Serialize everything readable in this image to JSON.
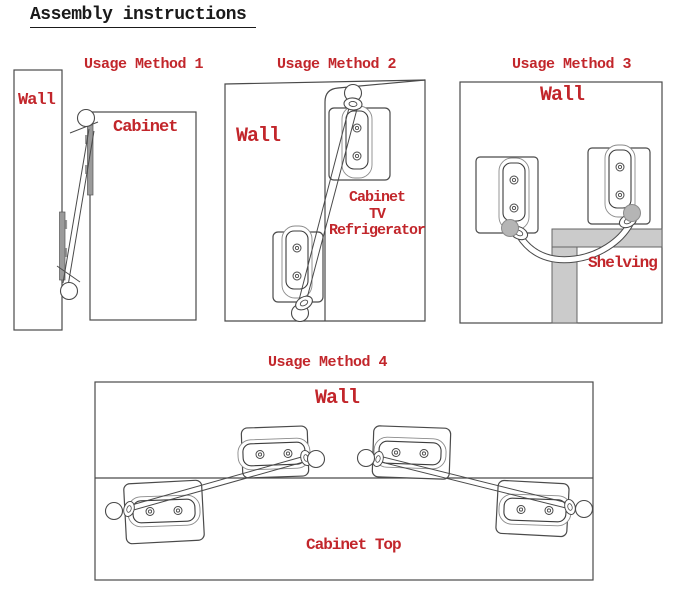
{
  "title": "Assembly instructions",
  "colors": {
    "accent_red": "#c2262b",
    "line": "#4a4a4a",
    "shelf_gray": "#cbcbcb",
    "ball_gray": "#b5b5b5"
  },
  "panels": {
    "method1": {
      "label": "Usage Method 1",
      "wall_label": "Wall",
      "cabinet_label": "Cabinet"
    },
    "method2": {
      "label": "Usage Method 2",
      "wall_label": "Wall",
      "target_line1": "Cabinet",
      "target_line2": "TV",
      "target_line3": "Refrigerator"
    },
    "method3": {
      "label": "Usage Method 3",
      "wall_label": "Wall",
      "shelving_label": "Shelving"
    },
    "method4": {
      "label": "Usage Method 4",
      "wall_label": "Wall",
      "cabinet_top_label": "Cabinet Top"
    }
  }
}
